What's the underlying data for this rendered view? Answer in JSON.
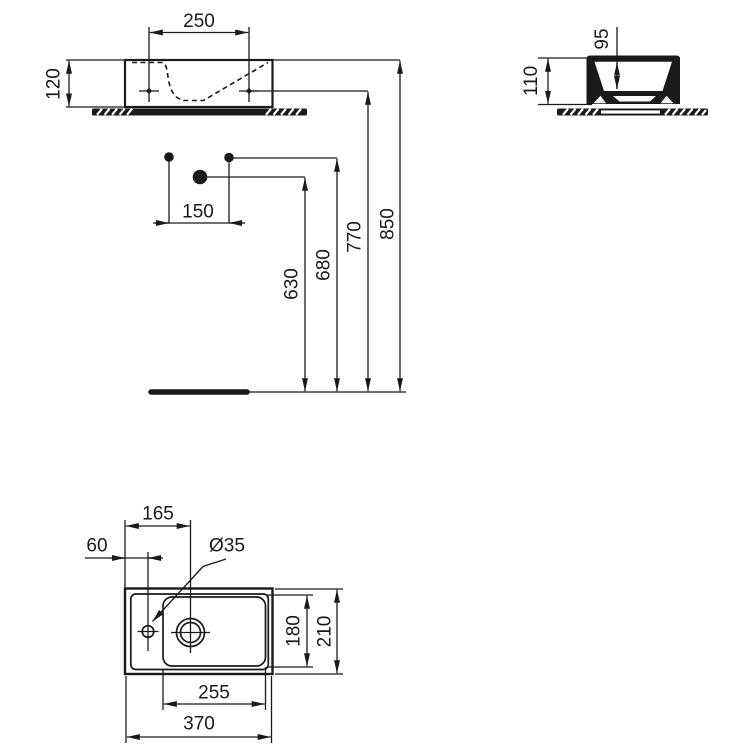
{
  "drawing": {
    "front_view": {
      "fixing_spacing": "250",
      "body_height": "120"
    },
    "side_view": {
      "inner_depth": "95",
      "overall_height": "110"
    },
    "elevation": {
      "bolt_spacing": "150",
      "waste_height": "630",
      "supply_height": "680",
      "fixing_height": "770",
      "rim_height": "850"
    },
    "plan_view": {
      "waste_offset": "165",
      "tap_hole_offset": "60",
      "tap_hole_diameter": "Ø35",
      "bowl_depth": "180",
      "overall_depth": "210",
      "bowl_width": "255",
      "overall_width": "370"
    }
  }
}
